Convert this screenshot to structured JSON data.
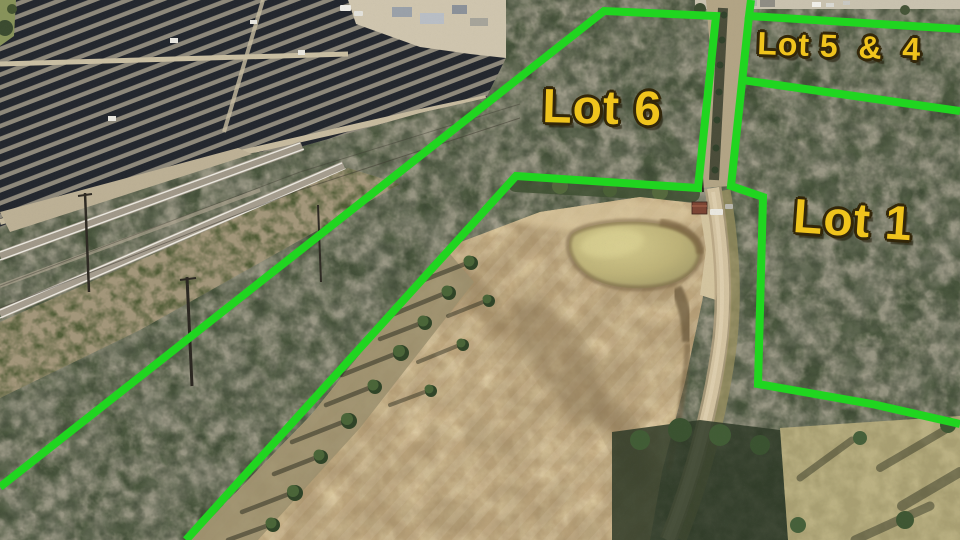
{
  "annotations": {
    "boundary_color": "#20d520",
    "label_color": "#f0c41d",
    "label_outline_color": "#33270a",
    "lots": [
      {
        "id": "lot-6",
        "label": "Lot 6"
      },
      {
        "id": "lot-5-4",
        "label": "Lot 5  &  4"
      },
      {
        "id": "lot-1",
        "label": "Lot 1"
      }
    ]
  },
  "scene": {
    "features": [
      "solar farm",
      "railroad corridor",
      "forest",
      "cleared field",
      "pond",
      "dirt road"
    ]
  }
}
